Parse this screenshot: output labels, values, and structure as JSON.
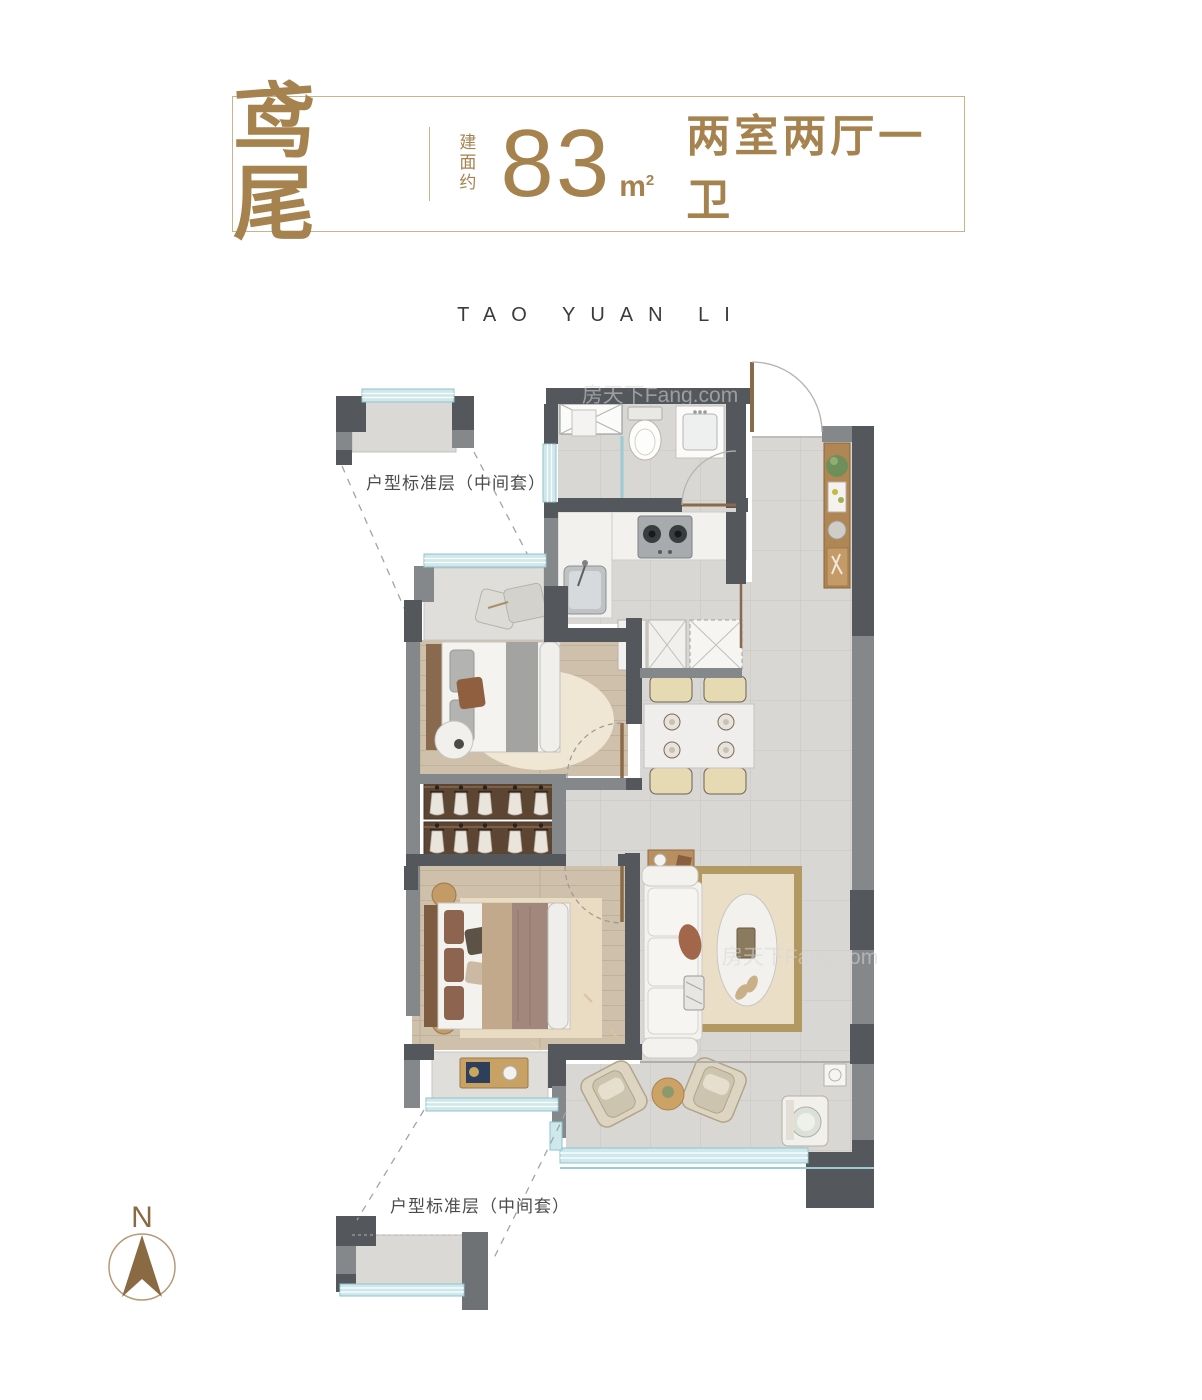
{
  "header": {
    "unit_name": "鸢尾",
    "area_label_vertical": "建面约",
    "area_value": "83",
    "area_unit_base": "m",
    "area_unit_exp": "2",
    "layout_summary": "两室两厅一卫"
  },
  "branding": {
    "project_name_spaced": "TAO YUAN LI",
    "site_watermark": "房天下Fang.com"
  },
  "plan": {
    "floor_label_top": "户型标准层（中间套）",
    "floor_label_bottom": "户型标准层（中间套）"
  },
  "compass": {
    "north_label": "N"
  },
  "colors": {
    "accent_gold": "#a6824e",
    "border_gold": "#cbb28b",
    "wall_dark": "#54585c",
    "wall_mid": "#84888b",
    "window_teal": "#cfe8ec",
    "window_frame": "#8fc3cb",
    "tile_floor": "#d9d7d4",
    "wood_floor": "#cec0aa",
    "wardrobe_brown": "#5d4533",
    "compass_brown": "#8a6a42"
  }
}
